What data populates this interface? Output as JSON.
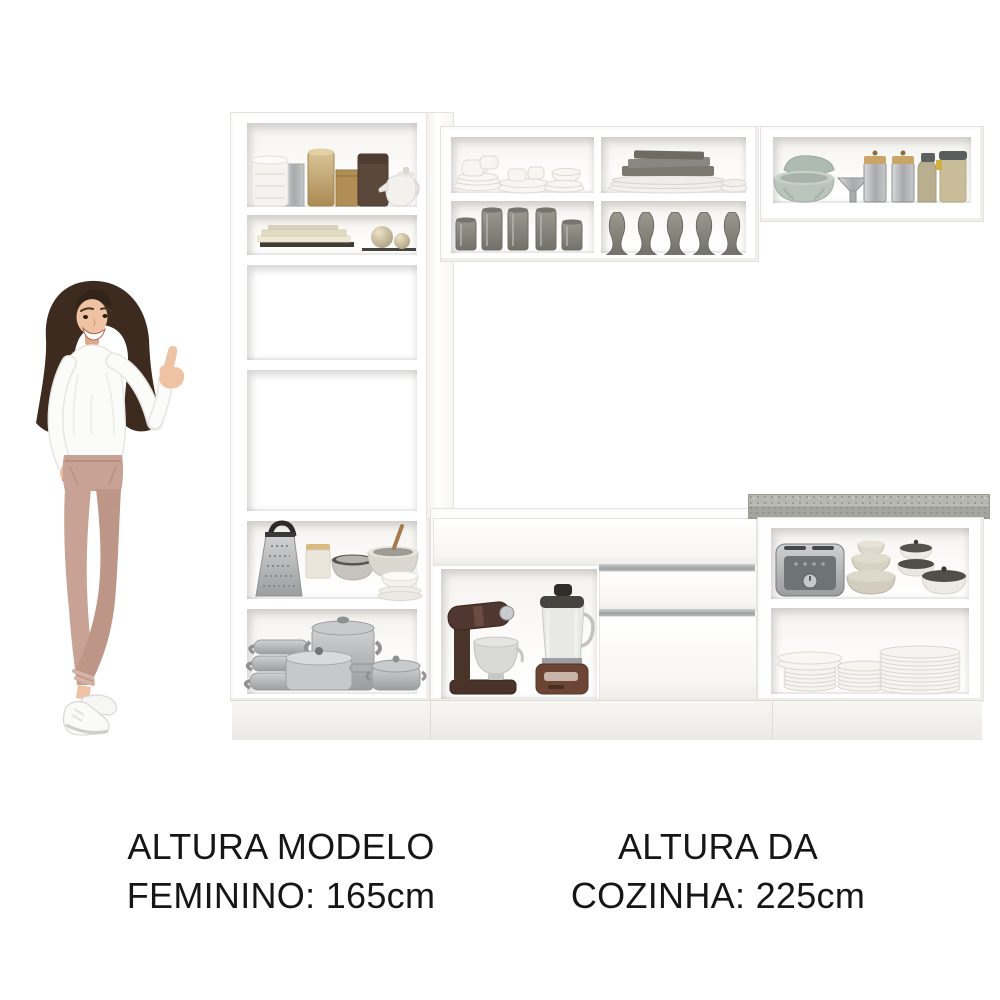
{
  "image": {
    "type": "kitchen-product-photo",
    "background": "#ffffff"
  },
  "captions": {
    "model": {
      "line1": "ALTURA MODELO",
      "line2": "FEMININO: 165cm"
    },
    "kitchen": {
      "line1": "ALTURA DA",
      "line2": "COZINHA: 225cm"
    }
  },
  "measurements": {
    "model_height_cm": 165,
    "kitchen_height_cm": 225
  },
  "figure": {
    "name": "female-model-pointing",
    "pose": "pointing-up-right",
    "outfit": [
      "white-long-sleeve-top",
      "rose-trousers",
      "white-sneakers"
    ]
  },
  "kitchen": {
    "cabinet_color": "#ffffff",
    "countertop_color": "#b2b2ac",
    "handle_color": "#a9adae",
    "sections": [
      {
        "name": "tall-cabinet-left",
        "items": [
          "storage-jars",
          "gold-canister",
          "brown-tin",
          "teapot",
          "books",
          "decor-spheres",
          "box-grater",
          "ceramic-canister",
          "mixing-bowls",
          "aluminum-pots"
        ]
      },
      {
        "name": "upper-cabinet-middle",
        "items": [
          "teacups-and-saucers",
          "gray-plate-stack",
          "drinking-glasses",
          "metal-vases"
        ]
      },
      {
        "name": "upper-cabinet-right",
        "items": [
          "green-bowls",
          "funnel",
          "metal-canisters",
          "storage-bottle",
          "storage-jar"
        ]
      },
      {
        "name": "base-cabinet-middle",
        "drawers": 3,
        "items": [
          "stand-mixer",
          "blender"
        ]
      },
      {
        "name": "base-cabinet-right",
        "items": [
          "toaster",
          "beige-bowl-stack",
          "lidded-bowls",
          "plate-stacks"
        ]
      }
    ]
  },
  "colors": {
    "background": "#ffffff",
    "cabinet_white": "#ffffff",
    "cabinet_edge": "#e4e3df",
    "countertop_gray": "#b2b2ac",
    "handle_gray": "#a9adae",
    "text_black": "#161616",
    "pants_rose": "#c7a295",
    "hair_brown": "#3c2b1e",
    "appliance_brown": "#4a3329",
    "blender_copper": "#6d4534",
    "sage_green": "#b9c4bc",
    "metal_gray": "#a9abac",
    "gold": "#c0a268"
  }
}
